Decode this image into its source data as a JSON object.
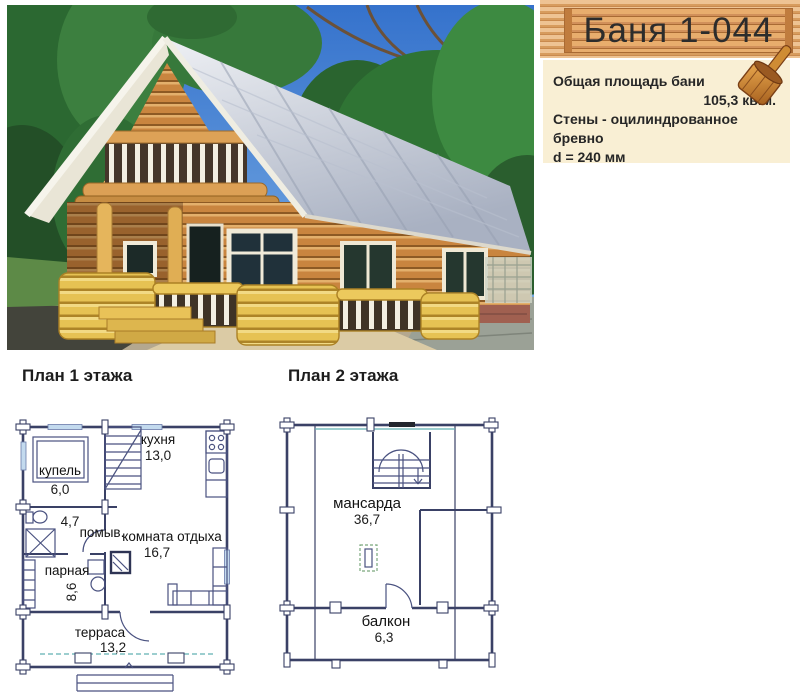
{
  "header": {
    "title": "Баня 1-044"
  },
  "info_box": {
    "line1": "Общая площадь бани",
    "area_value": "105,3 кв.м.",
    "line2": "Стены - оцилиндрованное бревно",
    "line3": "d = 240 мм"
  },
  "plan1": {
    "title": "План 1 этажа",
    "rooms": [
      {
        "name": "купель",
        "area": "6,0"
      },
      {
        "name": "кухня",
        "area": "13,0"
      },
      {
        "name": "помыв.",
        "area": "4,7"
      },
      {
        "name": "парная",
        "area": "8,6"
      },
      {
        "name": "комната отдыха",
        "area": "16,7"
      },
      {
        "name": "терраса",
        "area": "13,2"
      }
    ]
  },
  "plan2": {
    "title": "План 2 этажа",
    "rooms": [
      {
        "name": "мансарда",
        "area": "36,7"
      },
      {
        "name": "балкон",
        "area": "6,3"
      }
    ]
  },
  "icons": {
    "ladle": "wooden-sauna-ladle-icon"
  },
  "colors": {
    "banner_log": "#d79c5e",
    "banner_log_dark": "#a96a33",
    "info_bg": "#f9efd4",
    "plan_line": "#3a4166",
    "title_text": "#2c2c2c"
  }
}
